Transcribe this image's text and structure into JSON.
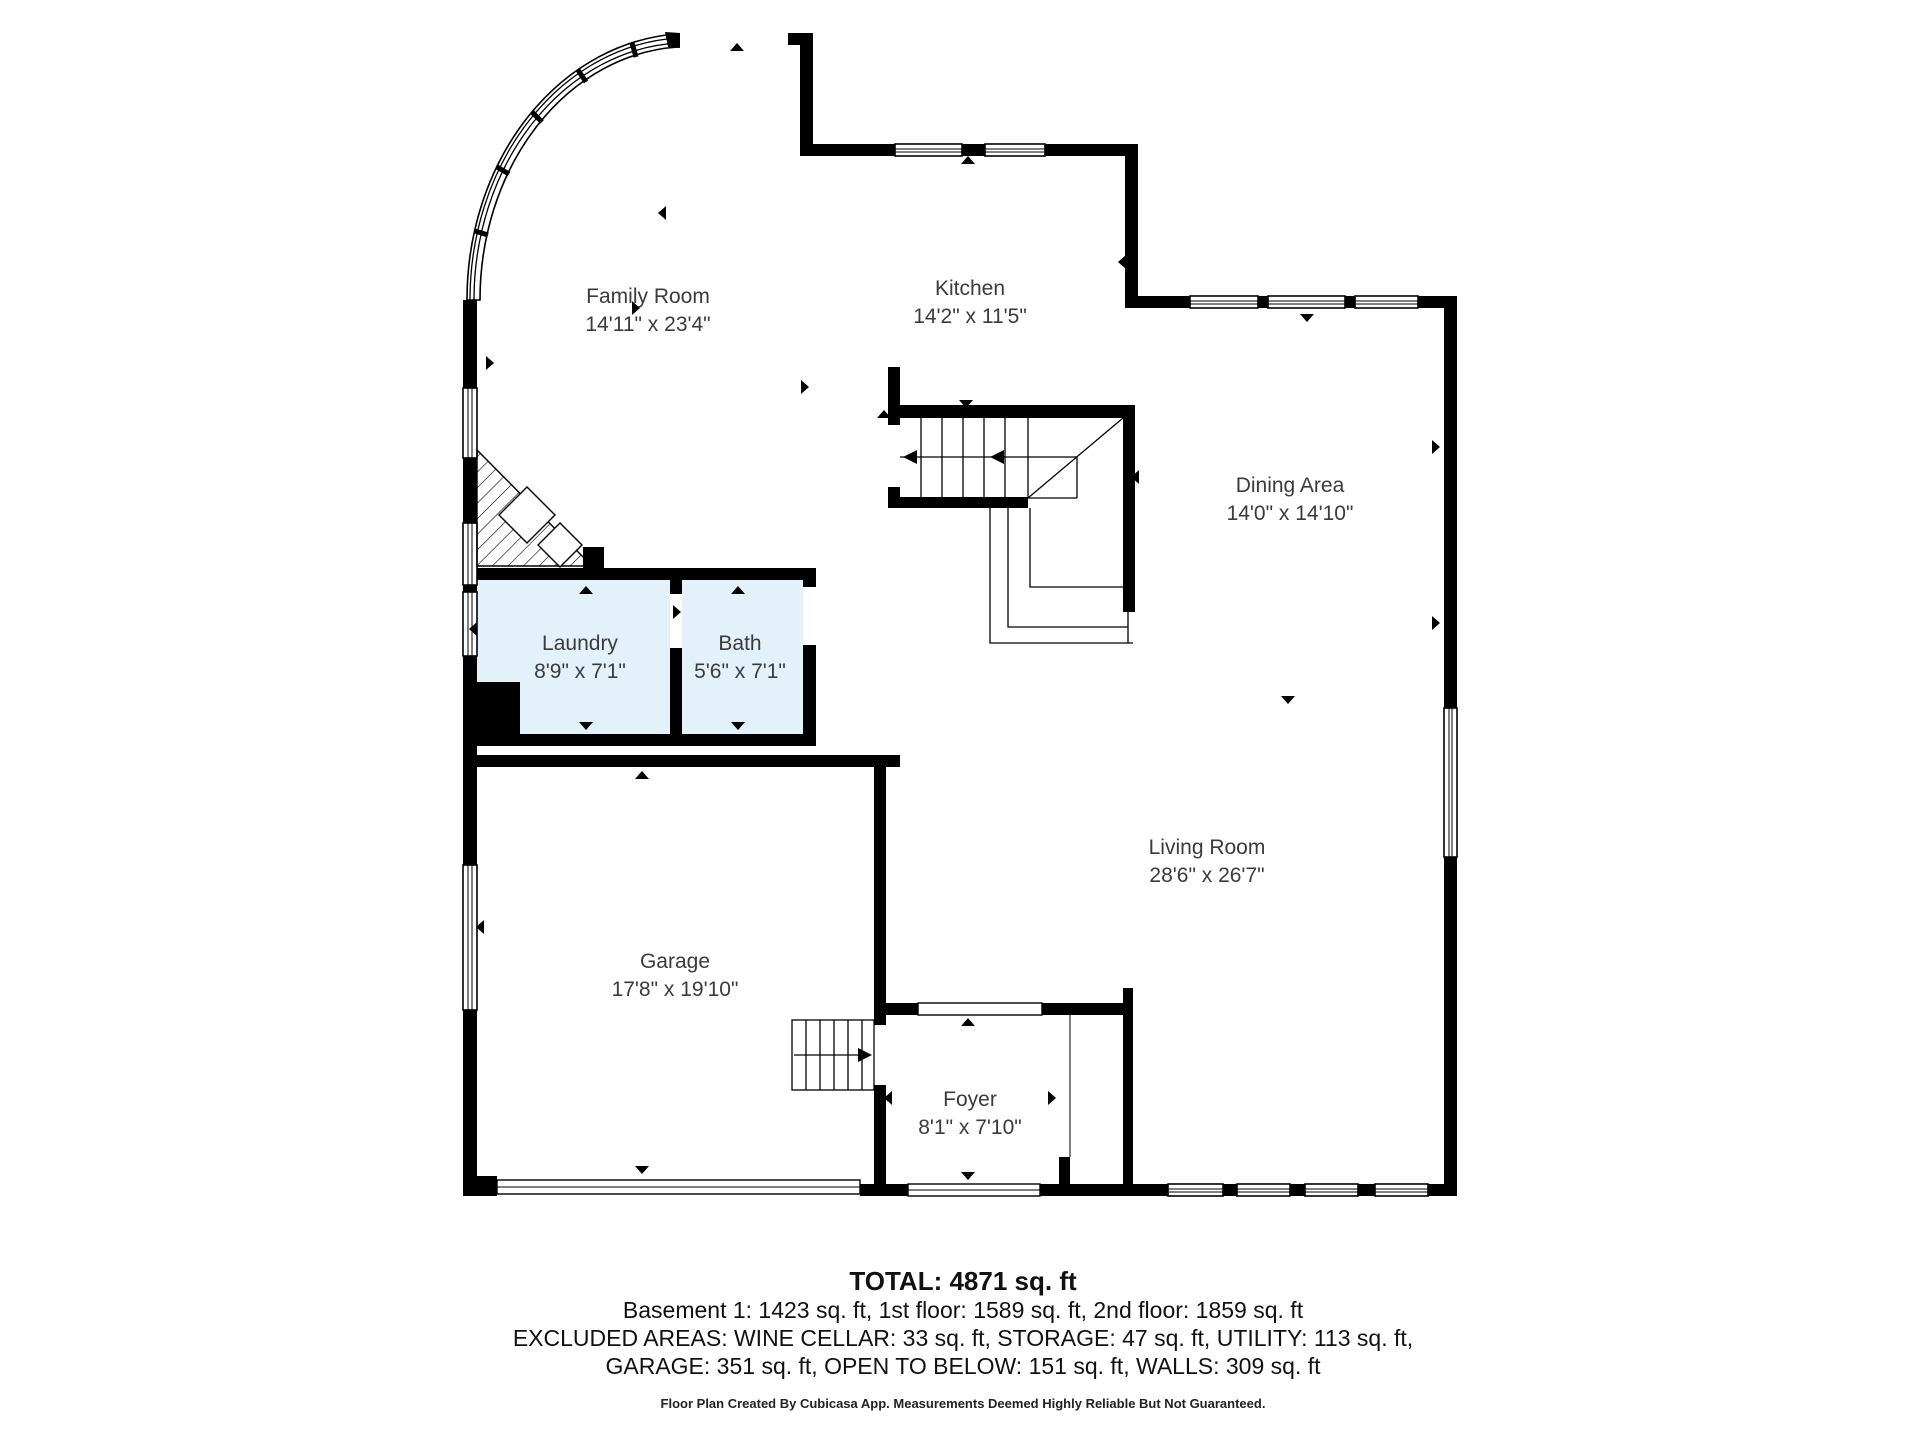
{
  "title": "First floor plan",
  "rooms": {
    "family_room": {
      "name": "Family Room",
      "dims": "14'11\" x 23'4\""
    },
    "kitchen": {
      "name": "Kitchen",
      "dims": "14'2\" x 11'5\""
    },
    "dining_area": {
      "name": "Dining Area",
      "dims": "14'0\" x 14'10\""
    },
    "laundry": {
      "name": "Laundry",
      "dims": "8'9\" x 7'1\""
    },
    "bath": {
      "name": "Bath",
      "dims": "5'6\" x 7'1\""
    },
    "garage": {
      "name": "Garage",
      "dims": "17'8\" x 19'10\""
    },
    "living_room": {
      "name": "Living Room",
      "dims": "28'6\" x 26'7\""
    },
    "foyer": {
      "name": "Foyer",
      "dims": "8'1\" x 7'10\""
    }
  },
  "summary": {
    "total": "TOTAL: 4871 sq. ft",
    "floors": "Basement 1: 1423 sq. ft, 1st floor: 1589 sq. ft, 2nd floor: 1859 sq. ft",
    "excluded_line1": "EXCLUDED AREAS: WINE CELLAR: 33 sq. ft, STORAGE: 47 sq. ft, UTILITY: 113 sq. ft,",
    "excluded_line2": "GARAGE: 351 sq. ft, OPEN TO BELOW: 151 sq. ft, WALLS: 309 sq. ft"
  },
  "disclaimer": "Floor Plan Created By Cubicasa App. Measurements Deemed Highly Reliable But Not Guaranteed.",
  "colors": {
    "background": "#ffffff",
    "wall": "#000000",
    "wet_room_fill": "#e3f1fb",
    "label_text": "#3b3b3b"
  },
  "icons": {
    "opening_marker": "small black triangle marking doors/openings/windows",
    "stair_direction_arrow": "arrow line showing stair travel direction"
  }
}
